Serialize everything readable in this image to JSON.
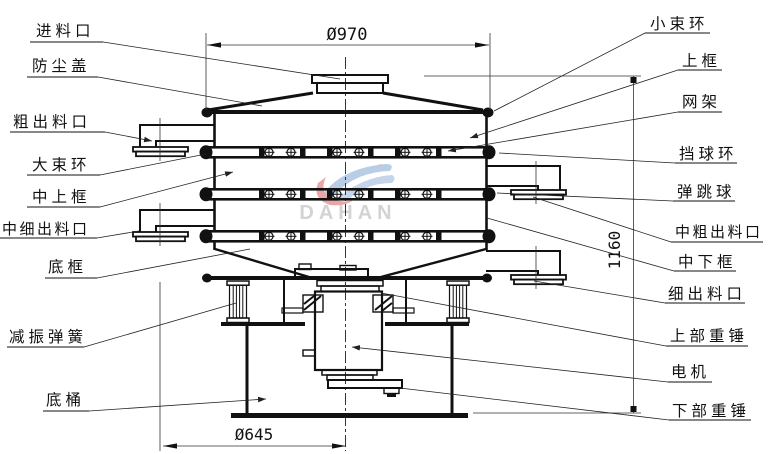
{
  "diagram": {
    "watermark": {
      "brand": "DAHAN",
      "registered": "®"
    },
    "dims": {
      "top_diameter": "Ø970",
      "total_height": "1160",
      "base_diameter": "Ø645"
    },
    "labels_left": [
      "进料口",
      "防尘盖",
      "粗出料口",
      "大束环",
      "中上框",
      "中细出料口",
      "底框",
      "减振弹簧",
      "底桶"
    ],
    "labels_right": [
      "小束环",
      "上框",
      "网架",
      "挡球环",
      "弹跳球",
      "中粗出料口",
      "中下框",
      "细出料口",
      "上部重锤",
      "电机",
      "下部重锤"
    ]
  }
}
